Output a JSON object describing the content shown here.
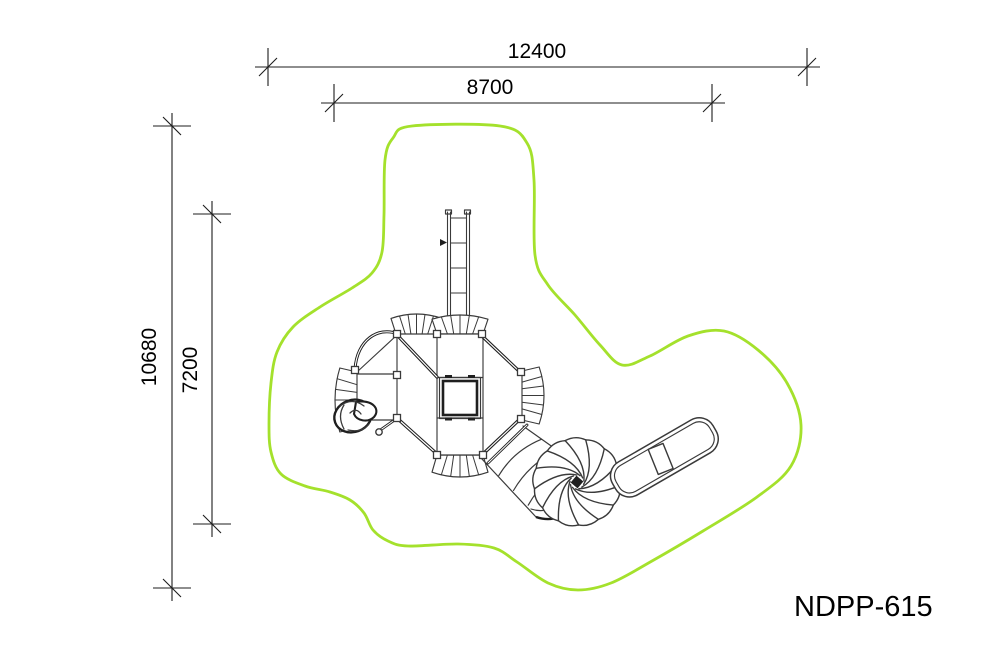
{
  "label": {
    "product_code": "NDPP-615"
  },
  "dims": {
    "outer_width": "12400",
    "inner_width": "8700",
    "outer_height": "10680",
    "inner_height": "7200"
  },
  "colors": {
    "safety_zone": "#a4e12c",
    "structure_line": "#3a3a3a",
    "structure_bold": "#1f1f1f",
    "dimension_line": "#1c1c1c",
    "text": "#000000",
    "background": "#ffffff"
  },
  "components": [
    "safety-zone-outline",
    "entrance-ladder",
    "climbing-wall-top-left",
    "climbing-wall-top-right",
    "climbing-wall-right",
    "climbing-wall-bottom",
    "climbing-wall-left",
    "main-deck",
    "activity-panel",
    "spiral-climber",
    "tube-slide",
    "spiral-slide",
    "slide-exit-chute"
  ]
}
